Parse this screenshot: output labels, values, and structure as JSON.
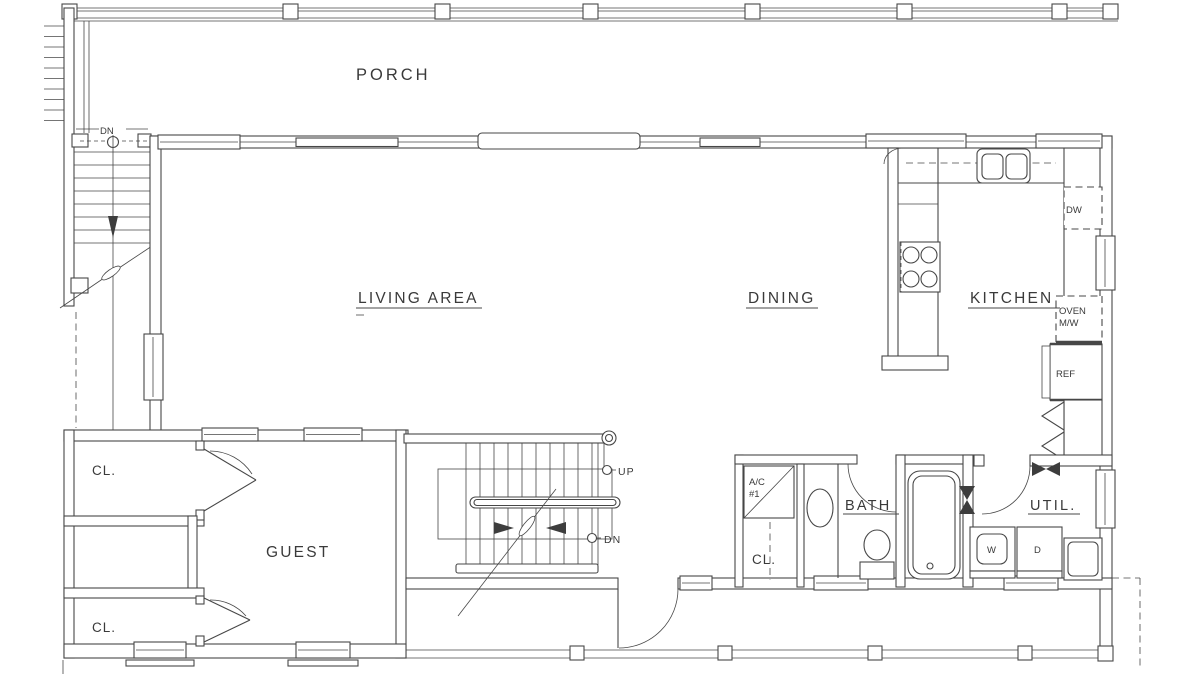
{
  "drawing": {
    "type": "residential-floor-plan",
    "bg_color": "#ffffff",
    "line_color": "#474747"
  },
  "rooms": {
    "porch": {
      "label": "PORCH"
    },
    "living_area": {
      "label": "LIVING AREA"
    },
    "dining": {
      "label": "DINING"
    },
    "kitchen": {
      "label": "KITCHEN"
    },
    "guest": {
      "label": "GUEST"
    },
    "bath": {
      "label": "BATH"
    },
    "utility": {
      "label": "UTIL."
    },
    "closet_upper": {
      "label": "CL."
    },
    "closet_lower": {
      "label": "CL."
    },
    "closet_hall": {
      "label": "CL."
    }
  },
  "appliances": {
    "dishwasher": {
      "label": "DW"
    },
    "oven_microwave": {
      "line1": "OVEN",
      "line2": "M/W"
    },
    "refrigerator": {
      "label": "REF"
    },
    "ac_unit": {
      "line1": "A/C",
      "line2": "#1"
    },
    "washer": {
      "label": "W"
    },
    "dryer": {
      "label": "D"
    },
    "cooktop": {
      "name": "cooktop-4-burner"
    },
    "kitchen_sink": {
      "name": "double-sink"
    },
    "bath_tub": {
      "name": "bathtub"
    },
    "toilet": {
      "name": "toilet"
    },
    "vanity_sink": {
      "name": "oval-sink"
    },
    "utility_sink": {
      "name": "utility-sink"
    }
  },
  "stairs": {
    "main_up_label": "UP",
    "main_down_label": "DN",
    "porch_down_label": "DN"
  }
}
